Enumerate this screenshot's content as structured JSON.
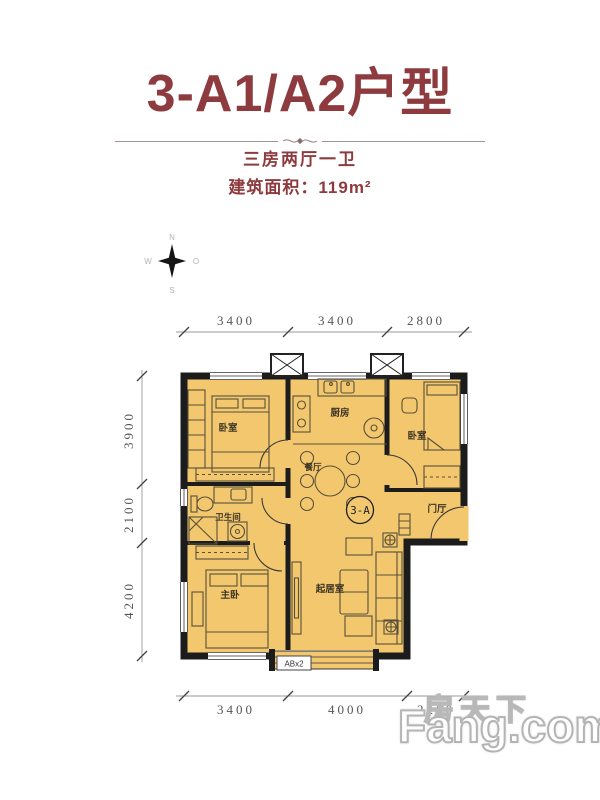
{
  "header": {
    "title": "3-A1/A2户型",
    "layout_line": "三房两厅一卫",
    "area_line": "建筑面积：119m²"
  },
  "compass": {
    "north": "N",
    "south": "S",
    "west": "W",
    "east": "O"
  },
  "plan": {
    "unit_badge": "3-A",
    "window_tag": "ABx2",
    "rooms": {
      "bedroom_nw": "卧室",
      "kitchen": "厨房",
      "bedroom_ne": "卧室",
      "dining": "餐厅",
      "bathroom": "卫生间",
      "entry": "门厅",
      "master": "主卧",
      "living": "起居室"
    },
    "dims": {
      "top": [
        "3400",
        "3400",
        "2800"
      ],
      "left": [
        "3900",
        "2100",
        "4200"
      ],
      "bottom": [
        "3400",
        "4000",
        "2200"
      ]
    }
  },
  "watermark": {
    "cn": "房天下",
    "en": "Fang.com"
  },
  "colors": {
    "accent": "#8d3b3e",
    "floor_fill": "#f2c76e",
    "wall": "#1c1c1c",
    "dim_text": "#555555",
    "watermark_outline": "#b8b8b8"
  }
}
